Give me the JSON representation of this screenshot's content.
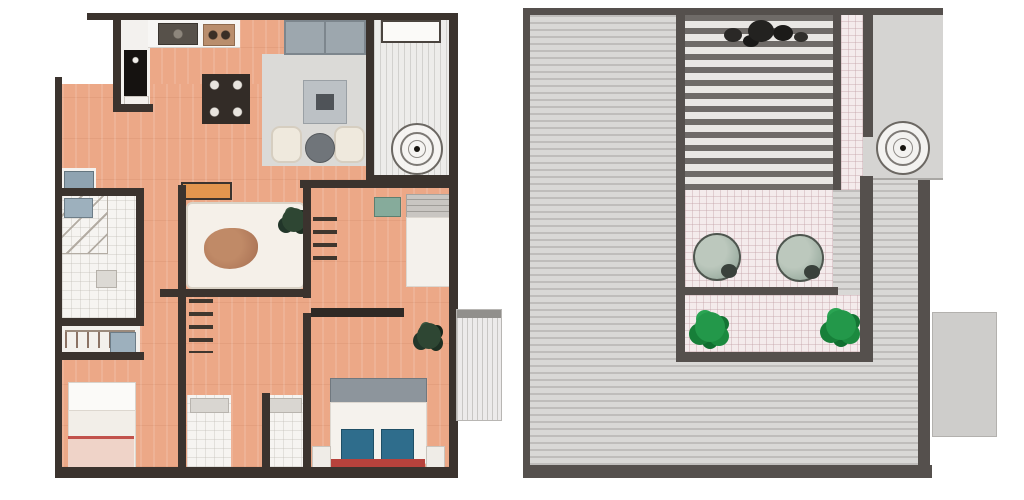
{
  "document": {
    "kind": "architectural floor plan drawing, two panels side by side, no visible text",
    "background": "#ffffff"
  },
  "left_panel": {
    "name": "apartment-floor-plan",
    "description": "Furnished apartment plan, terracotta wood flooring, dark walls",
    "rooms": [
      "kitchen",
      "living-dining-area",
      "den-lounge",
      "bathroom",
      "entry",
      "bedroom-middle-right",
      "bedroom-bottom-left",
      "master-bedroom",
      "walk-in-closet",
      "hall-bathrooms",
      "side-balcony"
    ],
    "furniture": [
      "kitchen-counter-with-sink",
      "cooktop",
      "tall-black-appliance",
      "dining-table-with-place-settings",
      "gray-sofa",
      "area-rug",
      "coffee-table",
      "two-cream-armchairs",
      "round-side-table",
      "daybed-with-pet",
      "potted-plant",
      "ladder-shelf",
      "single-bed-vertical",
      "single-bed-with-red-blanket",
      "wardrobe-rail-with-hangers",
      "closet-shelving",
      "double-bed-with-blue-pillows",
      "two-nightstands",
      "curtain-rod",
      "dark-plant",
      "balcony-planter-box"
    ],
    "compass_rose": {
      "cx": 417,
      "cy": 149,
      "radius": 26
    },
    "exterior_ledge": {
      "x": 457,
      "y": 310,
      "width": 44,
      "height": 110
    }
  },
  "right_panel": {
    "name": "roof-terrace-plan",
    "description": "Roof plan with striped decking surrounding a recessed terrace",
    "features": [
      "striped-roof-decking",
      "slatted-pergola",
      "pergola-planting",
      "tiled-patio",
      "two-round-lounge-chairs",
      "two-green-shrubs",
      "tile-walkway-strip",
      "gray-utility-panel",
      "roof-extension-slab"
    ],
    "compass_rose": {
      "cx": 903,
      "cy": 148,
      "radius": 27
    },
    "extension_slab": {
      "x": 932,
      "y": 312,
      "width": 65,
      "height": 125
    }
  },
  "colors": {
    "wall_dark": "#3b332e",
    "roof_wall": "#55504d",
    "wood_floor": "#eca887",
    "white_floor": "#f6f4f1",
    "rug_gray": "#dbdad7",
    "sofa_gray": "#9da7ae",
    "bed_linen": "#f4f1ec",
    "headboard_gray": "#8d959c",
    "pillow_blue": "#2f6d8c",
    "accent_red": "#b7423c",
    "blanket_pink": "#efd3c8",
    "cabinet_orange": "#e2954e",
    "pet_brown": "#b0795a",
    "plant_green": "#23984a",
    "plant_dark_green": "#2e4633",
    "roof_deck": "#d9d8d6",
    "roof_stripe": "#bfbdbb",
    "pergola_slat": "#6f6b68",
    "terrace_tile": "#f4ebec",
    "chair_sage": "#a9b7ac",
    "washer_blue": "#9db0bd",
    "appliance_black": "#151210"
  }
}
